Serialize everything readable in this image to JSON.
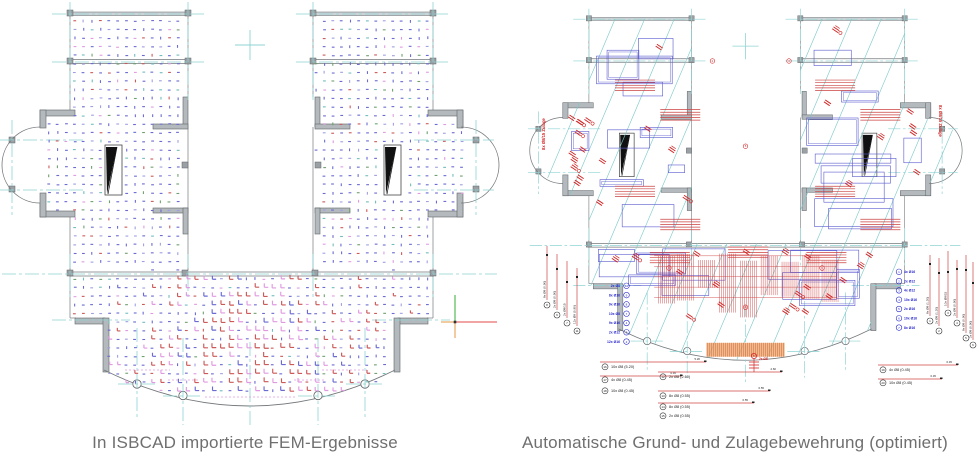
{
  "captions": {
    "left": "In ISBCAD importierte FEM-Ergebnisse",
    "right": "Automatische Grund- und Zulagebewehrung (optimiert)"
  },
  "colors": {
    "caption_text": "#6f6f6f",
    "wall_fill": "#b3b9bc",
    "wall_light": "#cdd2d5",
    "wall_edge": "#5f6568",
    "line": "#75797c",
    "axis": "#8fd3d3",
    "fem_blue": "#6a6ad2",
    "fem_blue_light": "#9f9fe2",
    "fem_red": "#cc5858",
    "fem_pink": "#e09ae0",
    "fem_green": "#6fa06f",
    "fem_teal": "#72bcbc",
    "rebar_blue": "#5b5bd0",
    "rebar_red": "#d42525",
    "hatch_red": "#cc4040",
    "span_teal": "#7ac8c8",
    "callout_blue": "#2525cc",
    "callout_black": "#222222",
    "leader_red": "#d04545",
    "orange_fill": "#eaa85e",
    "ucs_green": "#55bb55",
    "ucs_red": "#e86e6e",
    "ucs_orange": "#eaa960"
  },
  "right_callouts": {
    "left_stack": [
      {
        "n": "10",
        "t": "2x Ø8"
      },
      {
        "n": "9",
        "t": "8x Ø16"
      },
      {
        "n": "8",
        "t": "9x Ø16"
      },
      {
        "n": "7",
        "t": "10x Ø8"
      },
      {
        "n": "4",
        "t": "9x Ø16"
      },
      {
        "n": "3",
        "t": "2x Ø12"
      },
      {
        "n": "2",
        "t": "12x Ø16"
      }
    ],
    "right_stack": [
      {
        "n": "1",
        "t": "4x Ø16"
      },
      {
        "n": "2",
        "t": "2x Ø12"
      },
      {
        "n": "3",
        "t": "4x Ø12"
      },
      {
        "n": "4",
        "t": "10x Ø16"
      },
      {
        "n": "5",
        "t": "2x Ø16"
      },
      {
        "n": "6",
        "t": "10x Ø16"
      },
      {
        "n": "7",
        "t": "8x Ø16"
      }
    ],
    "left_leaders": [
      {
        "n": "8",
        "t": "8x Ø8 (0.90)"
      },
      {
        "n": "9",
        "t": "2x Ø8 (0.90)"
      },
      {
        "n": "7",
        "t": "2x Ø8/15"
      },
      {
        "n": "11",
        "t": "12x Ø8 (0.90)"
      }
    ],
    "right_leaders": [
      {
        "n": "1",
        "t": "8x Ø8 (1.20)"
      },
      {
        "n": "2",
        "t": "2x Ø8 (1.20)"
      },
      {
        "n": "3",
        "t": "10x Ø8/15"
      },
      {
        "n": "4",
        "t": "2x Ø8 (0.90)"
      },
      {
        "n": "5",
        "t": "8x Ø8 (0.90)"
      },
      {
        "n": "6",
        "t": "2x Ø8 (0.90)"
      }
    ],
    "bottom_groups": [
      {
        "x": 110,
        "rows": [
          {
            "n": "16",
            "t": "10x Ø8 (5.20)",
            "y": 368,
            "lineY": 362,
            "lineW": 106,
            "dim": "5.20"
          },
          {
            "n": "17",
            "t": "4x Ø8 (0.45)",
            "y": 381,
            "lineY": 376,
            "lineW": 82,
            "dim": "0.45"
          },
          {
            "n": "18",
            "t": "10x Ø8 (0.45)",
            "y": 392,
            "lineY": 0,
            "lineW": 0,
            "dim": ""
          }
        ]
      },
      {
        "x": 168,
        "rows": [
          {
            "n": "12",
            "t": "2x Ø8 (2.60)",
            "y": 378,
            "lineY": 372,
            "lineW": 124,
            "dim": "2.60"
          },
          {
            "n": "13",
            "t": "8x Ø8 (0.55)",
            "y": 397,
            "lineY": 391,
            "lineW": 112,
            "dim": "0.55"
          },
          {
            "n": "14",
            "t": "8x Ø8 (0.55)",
            "y": 408,
            "lineY": 403,
            "lineW": 96,
            "dim": "0.55"
          },
          {
            "n": "15",
            "t": "2x Ø8 (0.55)",
            "y": 417,
            "lineY": 0,
            "lineW": 0,
            "dim": ""
          }
        ]
      },
      {
        "x": 388,
        "rows": [
          {
            "n": "19",
            "t": "4x Ø8 (0.45)",
            "y": 371,
            "lineY": 365,
            "lineW": 80,
            "dim": "0.45"
          },
          {
            "n": "20",
            "t": "10x Ø8 (0.45)",
            "y": 384,
            "lineY": 379,
            "lineW": 64,
            "dim": "0.45"
          }
        ]
      }
    ],
    "side_labels": {
      "left": "8x Ø8/15 Zulage",
      "right": "8x Ø8/15 Zulage"
    },
    "center_mark": {
      "n": "21",
      "t": "2x Ø8"
    }
  }
}
